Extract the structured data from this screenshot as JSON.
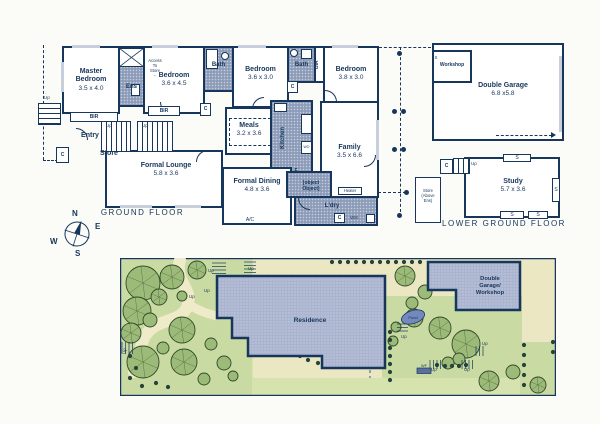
{
  "colors": {
    "wall": "#17365c",
    "wet_area": "#8c9cb8",
    "building_fill": "#aab4cf",
    "garden": "#c9dba2",
    "path": "#ece7c3",
    "tree": "#9dbb78"
  },
  "ground_floor": {
    "label": "GROUND FLOOR",
    "rooms": {
      "master_bedroom": {
        "name": "Master Bedroom",
        "dims": "3.5 x 4.0"
      },
      "ens": {
        "name": "Ens"
      },
      "access_store": {
        "line1": "Access",
        "line2": "To",
        "line3": "Store",
        "arrow": "←"
      },
      "bedroom2": {
        "name": "Bedroom",
        "dims": "3.6 x 4.5"
      },
      "bath1": {
        "name": "Bath"
      },
      "bedroom3": {
        "name": "Bedroom",
        "dims": "3.6 x 3.0"
      },
      "bath2": {
        "name": "Bath"
      },
      "bir_vertical": {
        "name": "BIR"
      },
      "bedroom4": {
        "name": "Bedroom",
        "dims": "3.8 x 3.0"
      },
      "bir1": {
        "name": "BIR"
      },
      "bir2": {
        "name": "BIR"
      },
      "entry": {
        "name": "Entry"
      },
      "store": {
        "name": "Store"
      },
      "formal_lounge": {
        "name": "Formal Lounge",
        "dims": "5.8 x 3.6"
      },
      "meals": {
        "name": "Meals",
        "dims": "3.2 x 3.6"
      },
      "kitchen": {
        "name": "Kitchen"
      },
      "formal_dining": {
        "name": "Formal Dining",
        "dims": "4.8 x 3.6"
      },
      "family": {
        "name": "Family",
        "dims": "3.5 x 6.6"
      },
      "ldry": {
        "name": "L'dry"
      },
      "wip": {
        "name": "WIP"
      },
      "fridge": "F",
      "heater": "Heater",
      "ac": "A/C",
      "wo": "WO",
      "wm": "WM",
      "cupboard": "C",
      "up": "Up",
      "store_above": {
        "line1": "Store",
        "line2": "(Above",
        "line3": "Ens)"
      }
    }
  },
  "lower_ground": {
    "label": "LOWER GROUND FLOOR",
    "rooms": {
      "workshop": {
        "name": "Workshop"
      },
      "double_garage": {
        "name": "Double Garage",
        "dims": "6.8 x5.8"
      },
      "study": {
        "name": "Study",
        "dims": "5.7 x 3.6"
      },
      "shelf": "S",
      "cupboard": "C",
      "up": "Up"
    }
  },
  "compass": {
    "n": "N",
    "e": "E",
    "s": "S",
    "w": "W"
  },
  "site_plan": {
    "residence": "Residence",
    "garage_line1": "Double",
    "garage_line2": "Garage/",
    "garage_line3": "Workshop",
    "pond": "Pond",
    "wf": "WF",
    "up": "Up"
  }
}
